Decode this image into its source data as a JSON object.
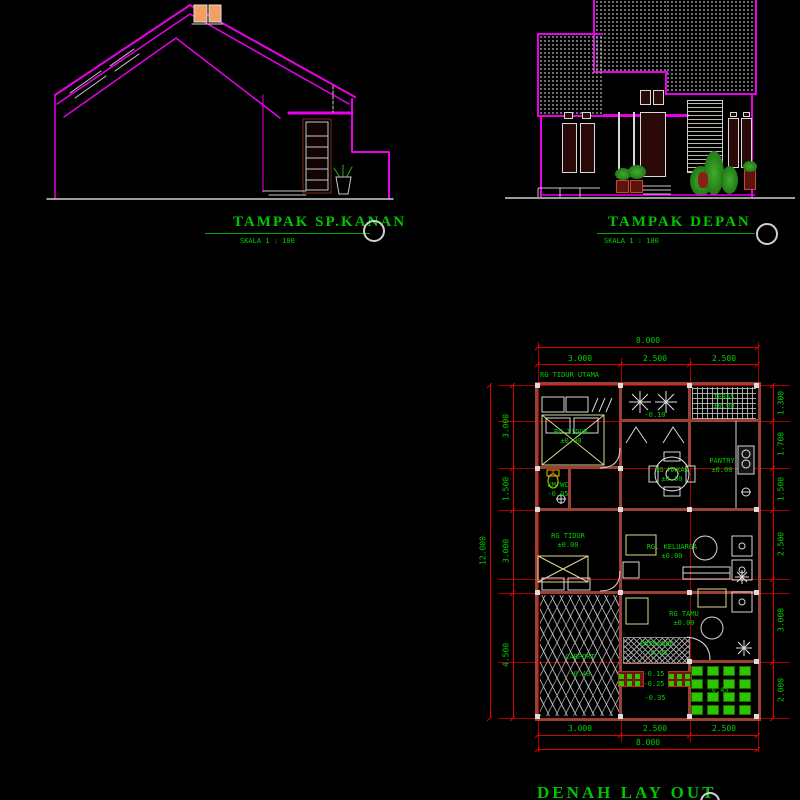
{
  "side_elevation": {
    "title": "TAMPAK SP.KANAN",
    "scale_label": "SKALA 1 : 100"
  },
  "front_elevation": {
    "title": "TAMPAK DEPAN",
    "scale_label": "SKALA 1 : 100"
  },
  "plan": {
    "title": "DENAH LAY OUT",
    "zone_label": "RG TIDUR UTAMA",
    "dim_top_total": "8.000",
    "dim_top": [
      "3.000",
      "2.500",
      "2.500"
    ],
    "dim_bottom": [
      "3.000",
      "2.500",
      "2.500"
    ],
    "dim_bottom_total": "8.000",
    "dim_left_total": "12.000",
    "dim_left": [
      "3.000",
      "1.500",
      "3.000",
      "4.500"
    ],
    "dim_right": [
      "1.300",
      "1.700",
      "1.500",
      "2.500",
      "3.000",
      "2.000"
    ],
    "rooms": {
      "bedroom1": {
        "name": "RG TIDUR",
        "level": "±0.00"
      },
      "kmwc": {
        "name": "KM/WC",
        "level": "-0.05"
      },
      "bedroom2": {
        "name": "RG TIDUR",
        "level": "±0.00"
      },
      "dining": {
        "name": "RG MAKAN",
        "level": "±0.00"
      },
      "pantry": {
        "name": "PANTRY",
        "level": "±0.00"
      },
      "family": {
        "name": "RG. KELUARGA",
        "level": "±0.00"
      },
      "guest": {
        "name": "RG TAMU",
        "level": "±0.00"
      },
      "carport": {
        "name": "CARPORT",
        "level": "-0.40"
      },
      "entrance": {
        "name": "ENTRANCE",
        "level": "-0.05"
      },
      "teras": {
        "name": "TERAS",
        "level": "±0.00"
      }
    },
    "spot_levels": {
      "courtyard": "-0.10",
      "step1": "-0.15",
      "step2": "-0.25",
      "step3": "-0.35",
      "garden": "-0.45"
    }
  },
  "colors": {
    "magenta": "#e800e8",
    "green": "#00d000",
    "red": "#cc0000",
    "wall": "#9c4036"
  }
}
